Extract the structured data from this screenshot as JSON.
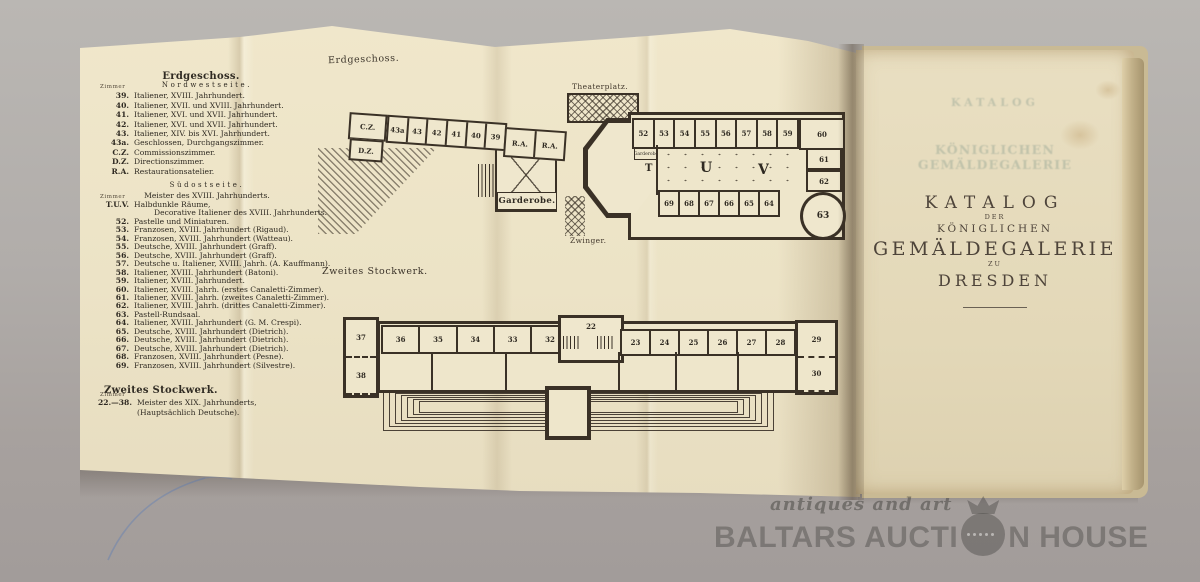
{
  "legend": {
    "title1": "Erdgeschoss.",
    "zimmer": "Zimmer",
    "nordwestseite": "Nordwestseite.",
    "nw_entries": [
      [
        "39.",
        "Italiener, XVIII. Jahrhundert."
      ],
      [
        "40.",
        "Italiener, XVII. und XVIII. Jahrhundert."
      ],
      [
        "41.",
        "Italiener, XVI. und XVII. Jahrhundert."
      ],
      [
        "42.",
        "Italiener, XVI. und XVII. Jahrhundert."
      ],
      [
        "43.",
        "Italiener, XIV. bis XVI. Jahrhundert."
      ],
      [
        "43a.",
        "Geschlossen, Durchgangszimmer."
      ],
      [
        "C.Z.",
        "Commissionszimmer."
      ],
      [
        "D.Z.",
        "Directionszimmer."
      ],
      [
        "R.A.",
        "Restaurationsatelier."
      ]
    ],
    "suedostseite": "Südostseite.",
    "so_head": "Meister des XVIII. Jahrhunderts.",
    "tuv_num": "T.U.V.",
    "tuv_line1": "Halbdunkle Räume,",
    "tuv_line2": "Decorative Italiener des XVIII. Jahrhunderts.",
    "so_entries": [
      [
        "52.",
        "Pastelle und Miniaturen."
      ],
      [
        "53.",
        "Franzosen, XVIII. Jahrhundert (Rigaud)."
      ],
      [
        "54.",
        "Franzosen, XVIII. Jahrhundert (Watteau)."
      ],
      [
        "55.",
        "Deutsche, XVIII. Jahrhundert (Graff)."
      ],
      [
        "56.",
        "Deutsche, XVIII. Jahrhundert (Graff)."
      ],
      [
        "57.",
        "Deutsche u. Italiener, XVIII. Jahrh. (A. Kauffmann)."
      ],
      [
        "58.",
        "Italiener, XVIII. Jahrhundert (Batoni)."
      ],
      [
        "59.",
        "Italiener, XVIII. Jahrhundert."
      ],
      [
        "60.",
        "Italiener, XVIII. Jahrh. (erstes Canaletti-Zimmer)."
      ],
      [
        "61.",
        "Italiener, XVIII. Jahrh. (zweites Canaletti-Zimmer)."
      ],
      [
        "62.",
        "Italiener, XVIII. Jahrh. (drittes Canaletti-Zimmer)."
      ],
      [
        "63.",
        "Pastell-Rundsaal."
      ],
      [
        "64.",
        "Italiener, XVIII. Jahrhundert (G. M. Crespi)."
      ],
      [
        "65.",
        "Deutsche, XVIII. Jahrhundert (Dietrich)."
      ],
      [
        "66.",
        "Deutsche, XVIII. Jahrhundert (Dietrich)."
      ],
      [
        "67.",
        "Deutsche, XVIII. Jahrhundert (Dietrich)."
      ],
      [
        "68.",
        "Franzosen, XVIII. Jahrhundert (Pesne)."
      ],
      [
        "69.",
        "Franzosen, XVIII. Jahrhundert (Silvestre)."
      ]
    ],
    "title2": "Zweites Stockwerk.",
    "sw_entry": [
      "22.—38.",
      "Meister des XIX. Jahrhunderts, (Hauptsächlich Deutsche)."
    ]
  },
  "plans": {
    "ground": {
      "label": "Erdgeschoss.",
      "theaterplatz": "Theaterplatz.",
      "zwinger": "Zwinger.",
      "garderobe": "Garderobe.",
      "garderobe_small": "Garderobe",
      "cz": "C.Z.",
      "dz": "D.Z.",
      "nw_rooms": [
        "43a",
        "43",
        "42",
        "41",
        "40",
        "39"
      ],
      "ra_rooms": [
        "R.A.",
        "R.A."
      ],
      "se_top_rooms": [
        "52",
        "53",
        "54",
        "55",
        "56",
        "57",
        "58",
        "59"
      ],
      "corner_room": "60",
      "right_col_rooms": [
        "61",
        "62"
      ],
      "round_room": "63",
      "hall_letters": [
        "T",
        "U",
        "V"
      ],
      "se_bottom_rooms": [
        "69",
        "68",
        "67",
        "66",
        "65",
        "64"
      ]
    },
    "second": {
      "label": "Zweites Stockwerk.",
      "left_rooms": [
        "37",
        "38"
      ],
      "top_left_rooms": [
        "36",
        "35",
        "34",
        "33",
        "32",
        "31"
      ],
      "center_room": "22",
      "top_right_rooms": [
        "23",
        "24",
        "25",
        "26",
        "27",
        "28"
      ],
      "right_rooms": [
        "29",
        "30"
      ]
    }
  },
  "title_page": {
    "ghost1": "KATALOG",
    "ghost2": "KÖNIGLICHEN GEMÄLDEGALERIE",
    "katalog": "KATALOG",
    "der": "DER",
    "koeniglichen": "KÖNIGLICHEN",
    "gemaeldegalerie": "GEMÄLDEGALERIE",
    "zu": "ZU",
    "dresden": "DRESDEN"
  },
  "watermark": {
    "tagline": "antiques and art",
    "name_left": "BALTARS AUCTI",
    "name_right": "N HOUSE"
  }
}
